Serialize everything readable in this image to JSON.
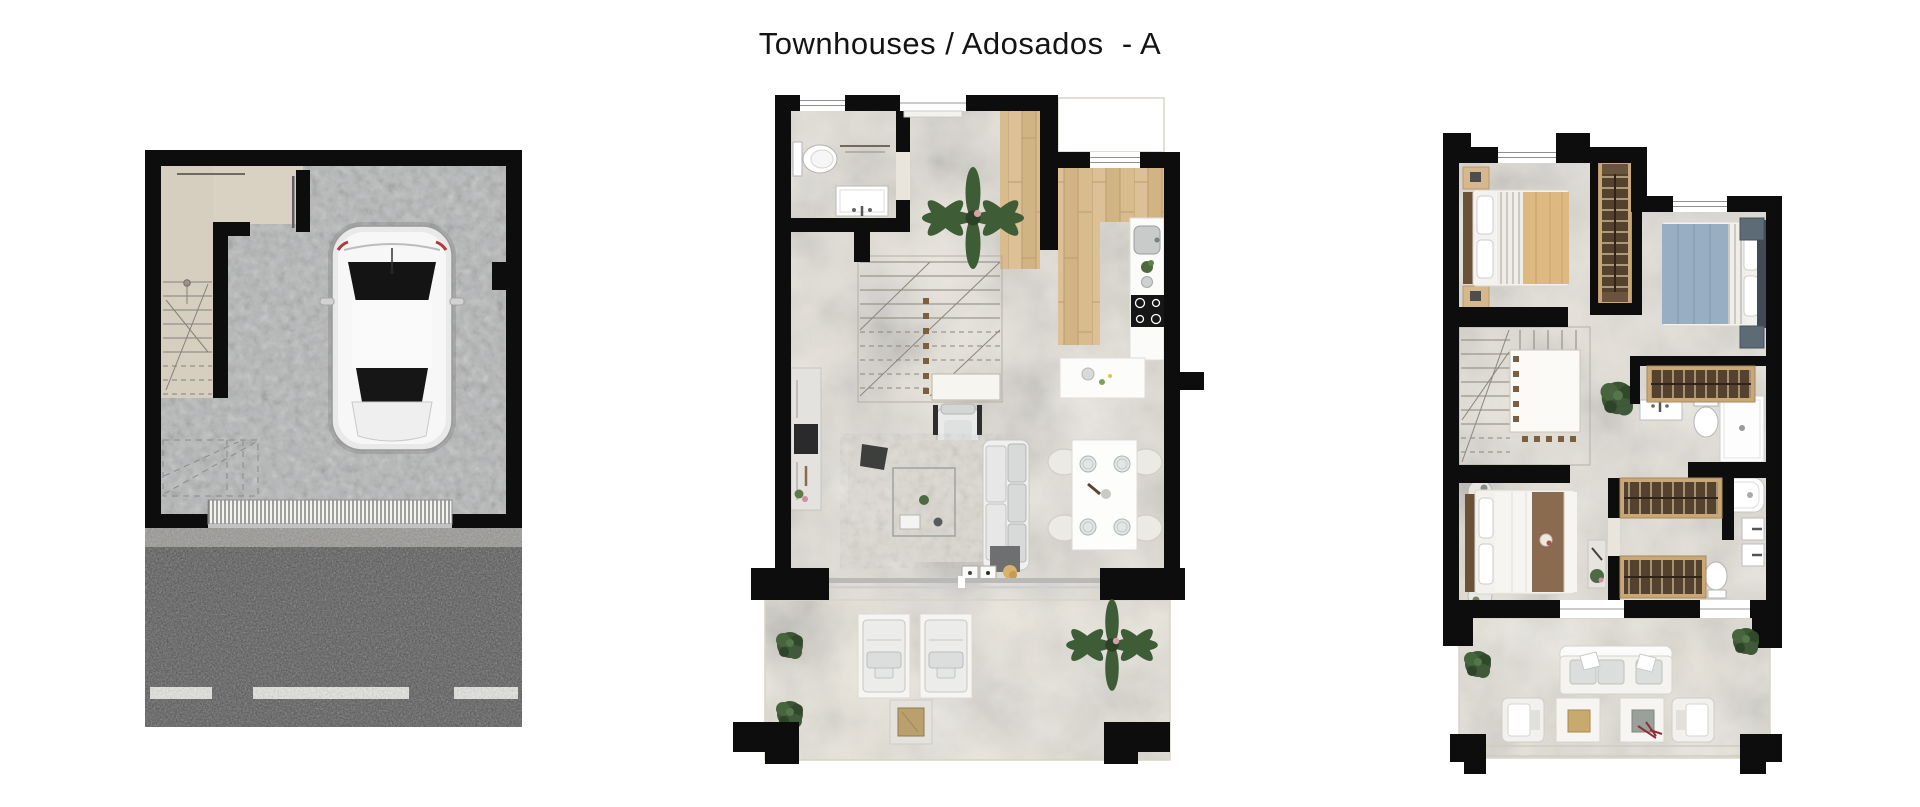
{
  "header": {
    "title": "Townhouses / Adosados  - A"
  },
  "sheet": {
    "background": "#ffffff",
    "wall_color": "#0d0d0d",
    "marble_floor": "#e9e5dc",
    "terrace_floor": "#ece8de",
    "concrete_floor": "#b5b6b7",
    "entry_wood_floor": "#d8bb90",
    "asphalt_road": "#3e3e3e",
    "gravel_strip": "#8f8e8a",
    "wardrobe_wood": "#54422f",
    "wardrobe_frame": "#c9a876",
    "bed_beige_blanket": "#ddb880",
    "bed_blue_blanket": "#97aec3",
    "bed_brown_blanket": "#8a6b4f",
    "plant_green": "#42603a",
    "plans": [
      {
        "id": "garage",
        "name": "garage-floor-plan",
        "rooms": [
          "garage",
          "staircase",
          "driveway"
        ],
        "furniture": [
          "car",
          "garage-door"
        ]
      },
      {
        "id": "ground",
        "name": "ground-floor-plan",
        "rooms": [
          "wc",
          "hall",
          "kitchen",
          "living-dining",
          "terrace"
        ],
        "furniture": [
          "toilet",
          "washbasin",
          "staircase",
          "plant",
          "kitchen-counter",
          "kitchen-sink",
          "hob",
          "island",
          "dining-table",
          "dining-chairs",
          "sofa",
          "armchair",
          "rug",
          "coffee-table",
          "sideboard",
          "lounge-chairs",
          "fire-table"
        ]
      },
      {
        "id": "upper",
        "name": "first-floor-plan",
        "rooms": [
          "bedroom-1",
          "bedroom-2",
          "master-bedroom",
          "bathroom-1",
          "bathroom-2",
          "hall",
          "terrace"
        ],
        "furniture": [
          "double-bed-beige",
          "double-bed-blue",
          "double-bed-master",
          "wardrobes",
          "shower",
          "bathtub",
          "toilets",
          "washbasins",
          "staircase",
          "outdoor-sofa",
          "outdoor-armchairs",
          "side-tables"
        ]
      }
    ]
  }
}
